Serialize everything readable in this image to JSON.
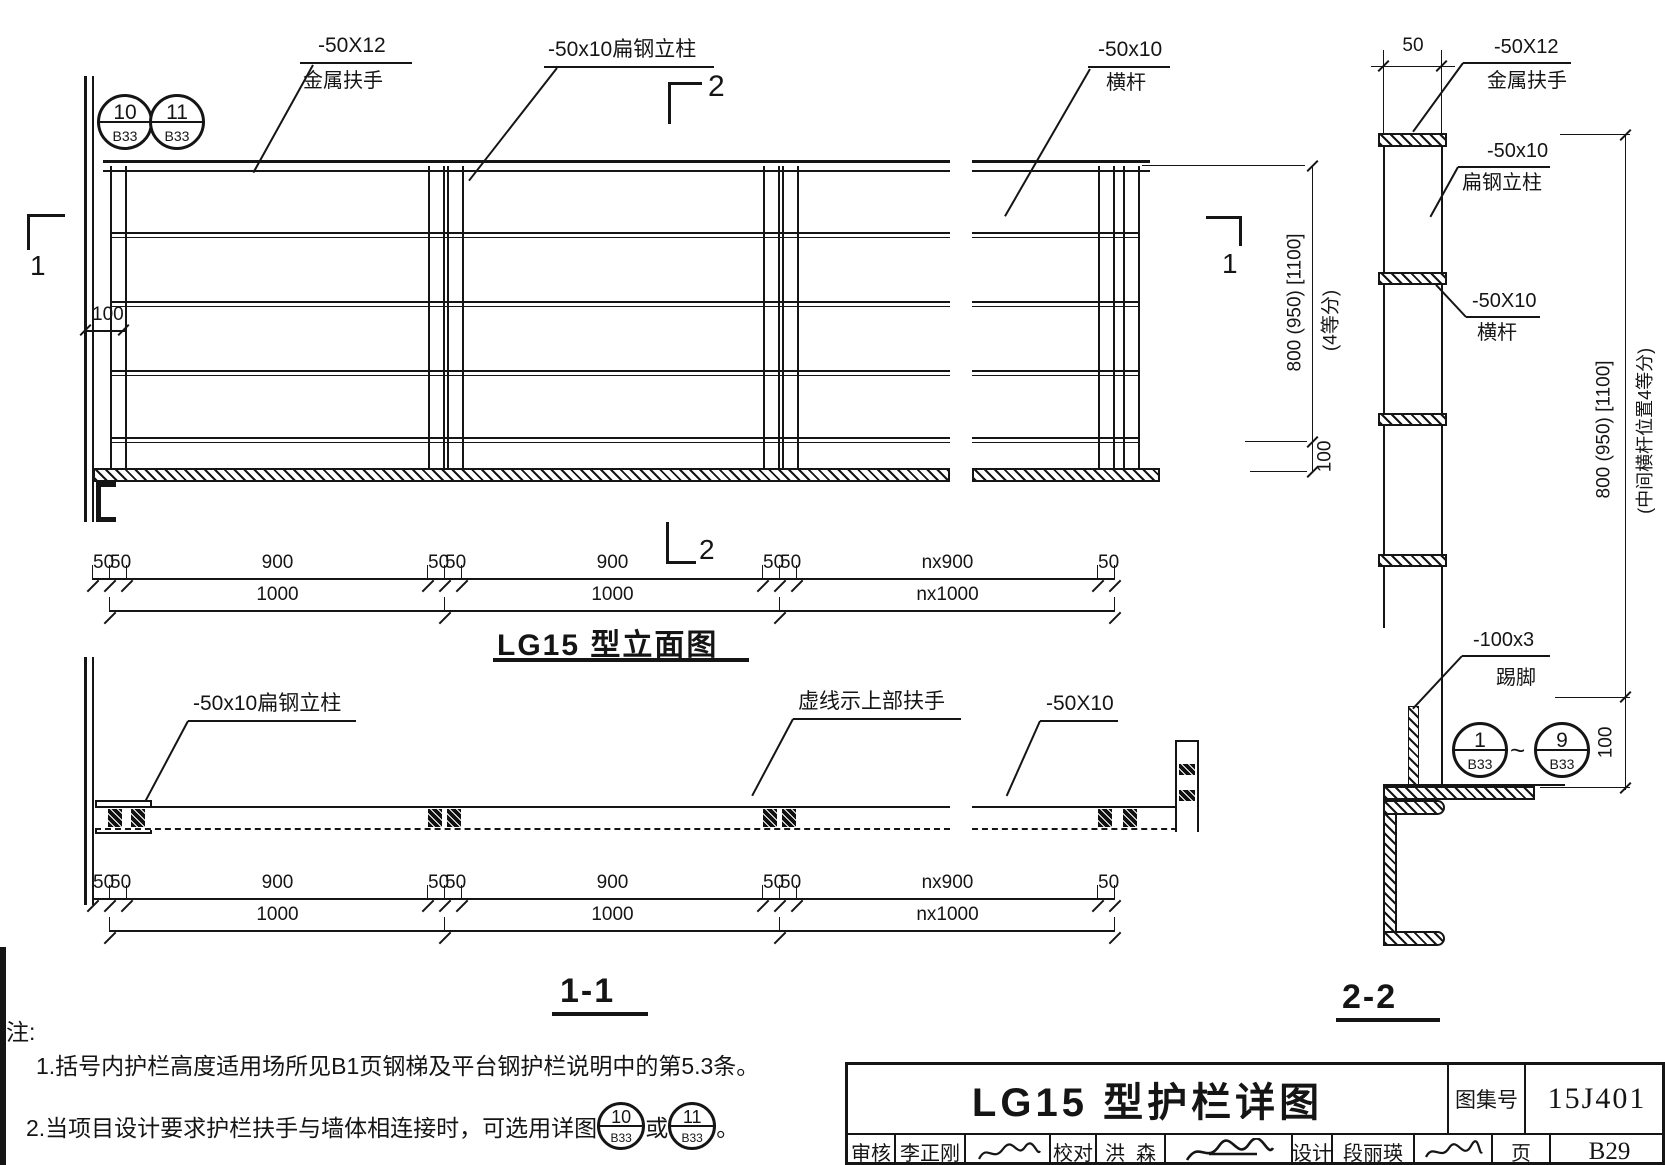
{
  "dims": {
    "row1": [
      "50",
      "50",
      "900",
      "50",
      "50",
      "900",
      "50",
      "50",
      "nx900",
      "50"
    ],
    "row2": [
      "1000",
      "1000",
      "nx1000"
    ]
  },
  "elevation": {
    "title": "LG15 型立面图",
    "callouts": [
      {
        "num": "10",
        "ref": "B33"
      },
      {
        "num": "11",
        "ref": "B33"
      }
    ],
    "handrail_label": {
      "line1": "-50X12",
      "line2": "金属扶手"
    },
    "post_label": "-50x10扁钢立柱",
    "rail_label": {
      "line1": "-50x10",
      "line2": "横杆"
    },
    "wall_gap_dim": "100",
    "height_dim": "800 (950) [1100]",
    "height_note": "(4等分)",
    "bottom_dim": "100",
    "marker_top": "2",
    "marker_bottom": "2",
    "marker_left": "1",
    "marker_right": "1"
  },
  "section_1_1": {
    "title": "1-1",
    "post_label": "-50x10扁钢立柱",
    "dashed_label": "虚线示上部扶手",
    "rail_label": "-50X10"
  },
  "section_2_2": {
    "title": "2-2",
    "top_dim": "50",
    "handrail_label": {
      "line1": "-50X12",
      "line2": "金属扶手"
    },
    "post_label": {
      "line1": "-50x10",
      "line2": "扁钢立柱"
    },
    "rail_label": {
      "line1": "-50X10",
      "line2": "横杆"
    },
    "kick_label": {
      "line1": "-100x3",
      "line2": "踢脚"
    },
    "callout_from": {
      "num": "1",
      "ref": "B33"
    },
    "callout_tilde": "~",
    "callout_to": {
      "num": "9",
      "ref": "B33"
    },
    "height_dim": "800 (950) [1100]",
    "height_note": "(中间横杆位置4等分)",
    "bottom_dim": "100"
  },
  "notes": {
    "heading": "注:",
    "item1": "1.括号内护栏高度适用场所见B1页钢梯及平台钢护栏说明中的第5.3条。",
    "item2_pre": "2.当项目设计要求护栏扶手与墙体相连接时，可选用详图",
    "item2_or": "或",
    "item2_period": "。",
    "circle1": {
      "num": "10",
      "ref": "B33"
    },
    "circle2": {
      "num": "11",
      "ref": "B33"
    }
  },
  "titleblock": {
    "drawing_title": "LG15 型护栏详图",
    "atlas_label": "图集号",
    "atlas_no": "15J401",
    "page_label": "页",
    "page_no": "B29",
    "reviewer_label": "审核",
    "reviewer_name": "李正刚",
    "checker_label": "校对",
    "checker_name": "洪  森",
    "designer_label": "设计",
    "designer_name": "段丽瑛"
  }
}
